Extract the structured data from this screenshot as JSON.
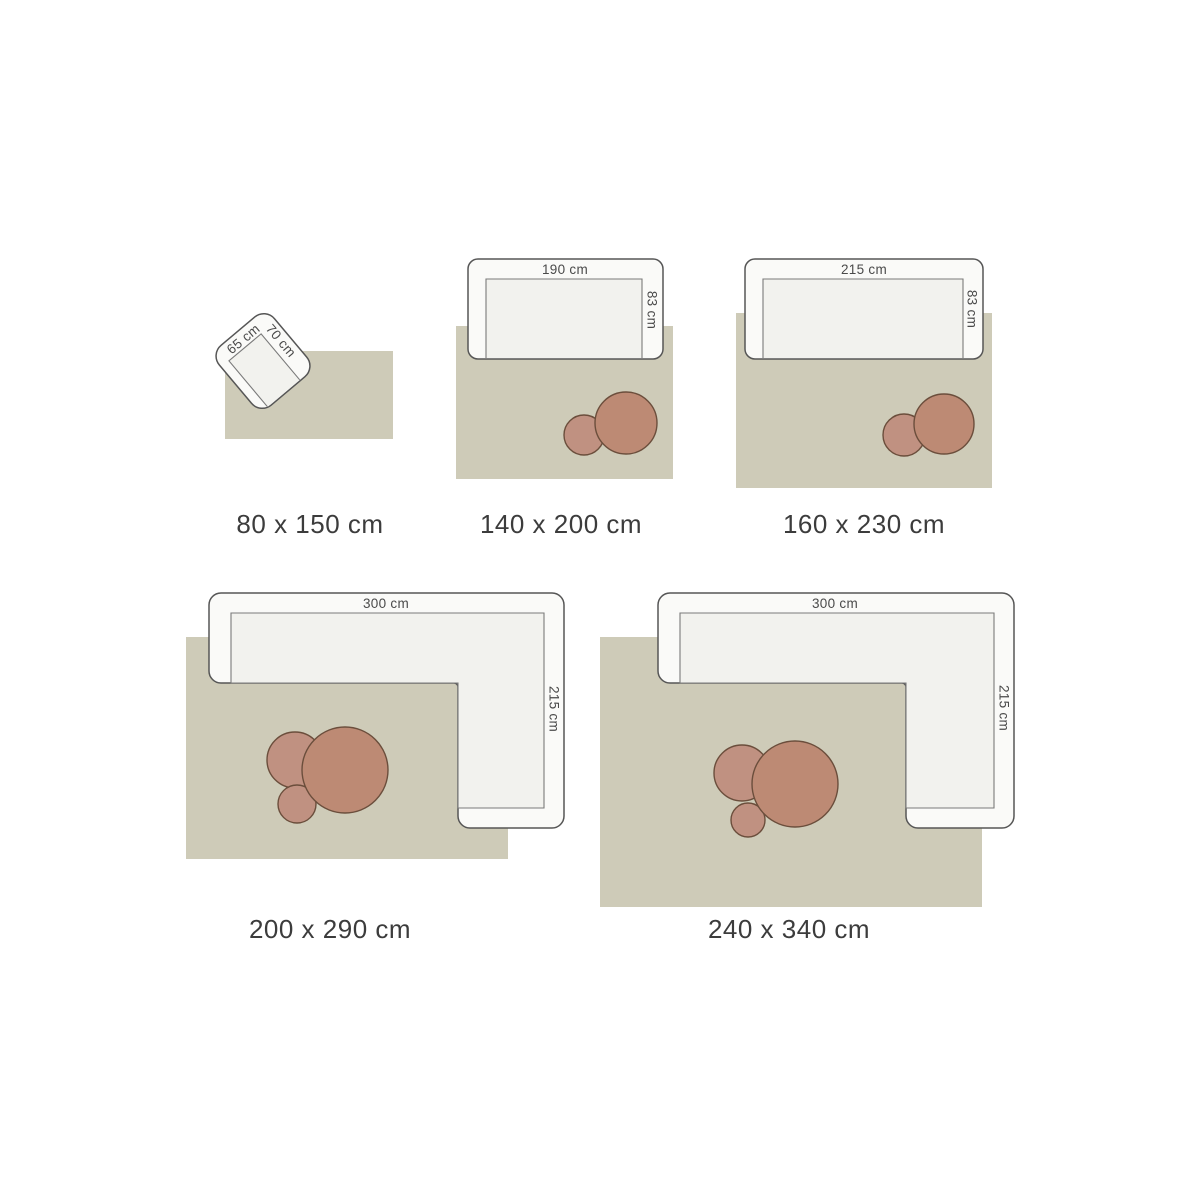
{
  "title": "Rug size guide",
  "colors": {
    "background": "#ffffff",
    "rug": "#cecbb8",
    "sofa_fill": "#fafaf8",
    "seat_fill": "#f2f2ee",
    "sofa_stroke": "#565656",
    "seat_stroke": "#7a7a7a",
    "table_light": "#c09181",
    "table_dark": "#bd8a74",
    "table_stroke": "#6b4e3c",
    "label_color": "#4a4a4a",
    "caption_color": "#3c3c3c"
  },
  "panels": [
    {
      "caption": "80 x 150 cm",
      "furniture": {
        "type": "armchair",
        "width_label": "65 cm",
        "depth_label": "70 cm"
      }
    },
    {
      "caption": "140 x 200 cm",
      "furniture": {
        "type": "sofa",
        "width_label": "190 cm",
        "depth_label": "83 cm"
      }
    },
    {
      "caption": "160 x 230 cm",
      "furniture": {
        "type": "sofa",
        "width_label": "215 cm",
        "depth_label": "83 cm"
      }
    },
    {
      "caption": "200 x 290 cm",
      "furniture": {
        "type": "corner-sofa",
        "width_label": "300 cm",
        "depth_label": "215 cm"
      }
    },
    {
      "caption": "240 x 340 cm",
      "furniture": {
        "type": "corner-sofa",
        "width_label": "300 cm",
        "depth_label": "215 cm"
      }
    }
  ]
}
